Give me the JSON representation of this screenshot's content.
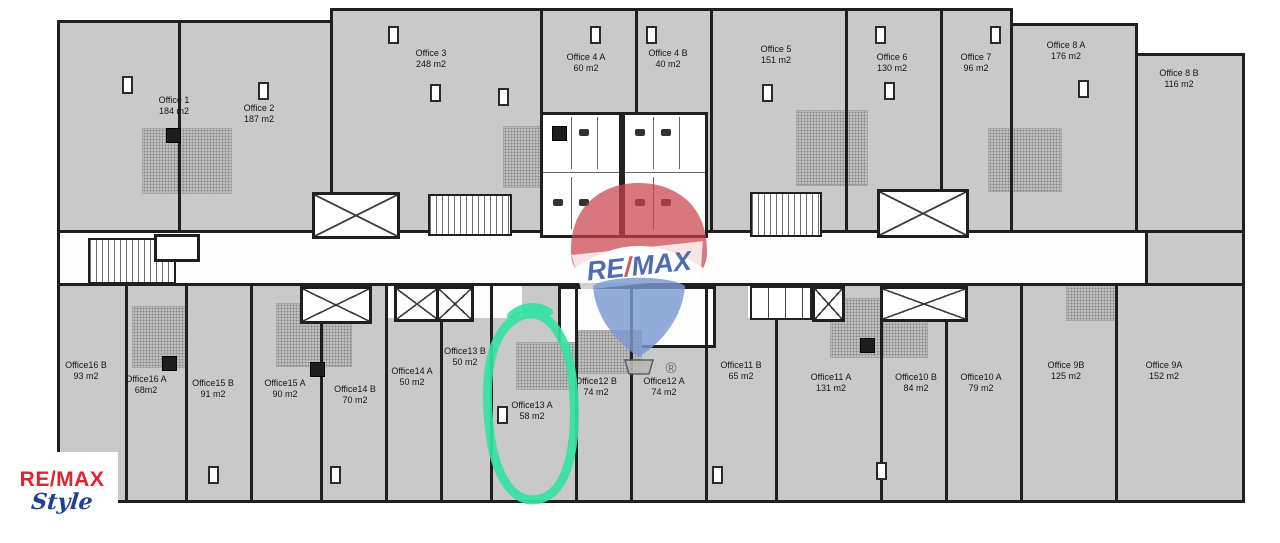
{
  "watermark": {
    "re": "RE",
    "slash": "/",
    "max": "MAX",
    "registered_mark": "®"
  },
  "agency_logo": {
    "brand_text": "RE/MAX",
    "style_text": "Style"
  },
  "highlight": {
    "highlighted_office": "Office13 A",
    "color": "#35e3a2"
  },
  "colors": {
    "plan_gray": "#c9c9c9",
    "wall_dark": "#1f1f1f",
    "highlight_teal": "#35e3a2",
    "remax_red": "#e0232d",
    "remax_blue": "#1d3f9e",
    "balloon_red": "#c9444c",
    "balloon_blue": "#7b99cf"
  },
  "offices": [
    {
      "name": "Office 1",
      "area": "184 m2"
    },
    {
      "name": "Office 2",
      "area": "187 m2"
    },
    {
      "name": "Office 3",
      "area": "248 m2"
    },
    {
      "name": "Office 4 A",
      "area": "60 m2"
    },
    {
      "name": "Office 4 B",
      "area": "40 m2"
    },
    {
      "name": "Office 5",
      "area": "151 m2"
    },
    {
      "name": "Office 6",
      "area": "130 m2"
    },
    {
      "name": "Office 7",
      "area": "96 m2"
    },
    {
      "name": "Office 8 A",
      "area": "176 m2"
    },
    {
      "name": "Office 8 B",
      "area": "116 m2"
    },
    {
      "name": "Office16 B",
      "area": "93 m2"
    },
    {
      "name": "Office16 A",
      "area": "68m2"
    },
    {
      "name": "Office15 B",
      "area": "91 m2"
    },
    {
      "name": "Office15 A",
      "area": "90 m2"
    },
    {
      "name": "Office14 B",
      "area": "70 m2"
    },
    {
      "name": "Office14 A",
      "area": "50 m2"
    },
    {
      "name": "Office13 B",
      "area": "50 m2"
    },
    {
      "name": "Office13 A",
      "area": "58 m2"
    },
    {
      "name": "Office12 B",
      "area": "74 m2"
    },
    {
      "name": "Office12 A",
      "area": "74 m2"
    },
    {
      "name": "Office11 B",
      "area": "65 m2"
    },
    {
      "name": "Office11 A",
      "area": "131 m2"
    },
    {
      "name": "Office10 B",
      "area": "84 m2"
    },
    {
      "name": "Office10 A",
      "area": "79 m2"
    },
    {
      "name": "Office 9B",
      "area": "125 m2"
    },
    {
      "name": "Office 9A",
      "area": "152 m2"
    }
  ]
}
